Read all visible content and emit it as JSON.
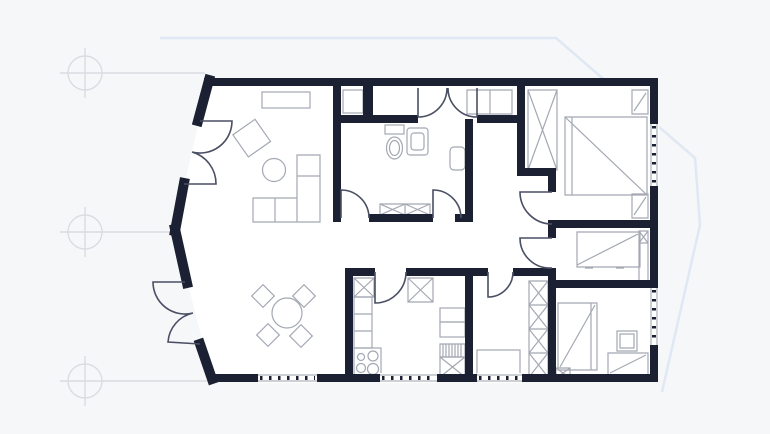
{
  "document": {
    "type": "apartment-floor-plan",
    "canvas": {
      "width": 770,
      "height": 434
    }
  },
  "colors": {
    "page": "#f6f7f9",
    "floor": "#ffffff",
    "wall": "#1c2033",
    "door": "#4a4f63",
    "furniture": "#a3a8b2",
    "window_frame": "#9aa0aa",
    "window_tick": "#1c2033",
    "background_outline": "#e0e8f4",
    "grid": "#d9dce2"
  },
  "layers": [
    {
      "name": "background-grid",
      "stroke": "grid",
      "width": 1.4,
      "items": [
        {
          "name": "grid-line-top",
          "kind": "line",
          "x1": 60,
          "y1": 73,
          "x2": 205,
          "y2": 73
        },
        {
          "name": "grid-line-middle",
          "kind": "line",
          "x1": 60,
          "y1": 232,
          "x2": 172,
          "y2": 232
        },
        {
          "name": "grid-line-bottom",
          "kind": "line",
          "x1": 60,
          "y1": 381,
          "x2": 210,
          "y2": 381
        },
        {
          "name": "grid-cross-top",
          "kind": "line",
          "x1": 85,
          "y1": 48,
          "x2": 85,
          "y2": 98
        },
        {
          "name": "grid-cross-middle",
          "kind": "line",
          "x1": 85,
          "y1": 207,
          "x2": 85,
          "y2": 257
        },
        {
          "name": "grid-cross-bottom",
          "kind": "line",
          "x1": 85,
          "y1": 356,
          "x2": 85,
          "y2": 406
        },
        {
          "name": "grid-marker-top",
          "kind": "circle",
          "cx": 85,
          "cy": 73,
          "r": 17
        },
        {
          "name": "grid-marker-middle",
          "kind": "circle",
          "cx": 85,
          "cy": 232,
          "r": 17
        },
        {
          "name": "grid-marker-bottom",
          "kind": "circle",
          "cx": 85,
          "cy": 381,
          "r": 17
        }
      ]
    },
    {
      "name": "building-outline",
      "stroke": "background_outline",
      "width": 2.5,
      "items": [
        {
          "name": "building-outline-path",
          "kind": "path",
          "d": "M160,38 L556,38 L695,158 L700,225 L662,392"
        }
      ]
    },
    {
      "name": "floor",
      "fill": "floor",
      "items": [
        {
          "name": "floor-area",
          "kind": "polygon",
          "points": "208,82 654,82 654,378 212,378 174,230"
        }
      ]
    },
    {
      "name": "furniture",
      "stroke": "furniture",
      "width": 1.2,
      "items": [
        {
          "name": "sideboard",
          "kind": "rect",
          "x": 262,
          "y": 92,
          "w": 48,
          "h": 16
        },
        {
          "name": "armchair",
          "kind": "rect",
          "x": 238,
          "y": 125,
          "w": 27,
          "h": 27,
          "transform": "rotate(-35 251 138)"
        },
        {
          "name": "coffee-table",
          "kind": "circle",
          "cx": 274,
          "cy": 170,
          "r": 11.5
        },
        {
          "name": "corner-sofa",
          "kind": "path",
          "d": "M253,198 L297,198 L297,155 L320,155 L320,222 L253,222 Z M275,198 L275,222 M297,198 L297,222 M297,176 L320,176"
        },
        {
          "name": "dining-table",
          "kind": "circle",
          "cx": 287,
          "cy": 313,
          "r": 15
        },
        {
          "name": "dining-chair",
          "kind": "rect",
          "x": 255,
          "y": 288,
          "w": 16,
          "h": 16,
          "transform": "rotate(45 263 296)"
        },
        {
          "name": "dining-chair",
          "kind": "rect",
          "x": 296,
          "y": 288,
          "w": 16,
          "h": 16,
          "transform": "rotate(45 304 296)"
        },
        {
          "name": "dining-chair",
          "kind": "rect",
          "x": 260,
          "y": 327,
          "w": 16,
          "h": 16,
          "transform": "rotate(45 268 335)"
        },
        {
          "name": "dining-chair",
          "kind": "rect",
          "x": 293,
          "y": 328,
          "w": 16,
          "h": 16,
          "transform": "rotate(45 301 336)"
        },
        {
          "name": "closet-shelf",
          "kind": "rect",
          "x": 343,
          "y": 90,
          "w": 20,
          "h": 23
        },
        {
          "name": "entry-closet",
          "kind": "path",
          "d": "M467,90 H512 V114 H467 Z M490,90 V114"
        },
        {
          "name": "toilet-tank",
          "kind": "rect",
          "x": 385,
          "y": 125,
          "w": 19,
          "h": 9
        },
        {
          "name": "toilet-bowl",
          "kind": "ellipse",
          "cx": 394.5,
          "cy": 148,
          "rx": 8,
          "ry": 11
        },
        {
          "name": "toilet-bowl-inner",
          "kind": "ellipse",
          "cx": 394.5,
          "cy": 148,
          "rx": 5,
          "ry": 7.5
        },
        {
          "name": "washbasin",
          "kind": "rect",
          "x": 407,
          "y": 128,
          "w": 21,
          "h": 27,
          "rx": 3
        },
        {
          "name": "washbasin-inner",
          "kind": "rect",
          "x": 411,
          "y": 133,
          "w": 13,
          "h": 17,
          "rx": 3
        },
        {
          "name": "wall-basin",
          "kind": "rect",
          "x": 450,
          "y": 147,
          "w": 15,
          "h": 23,
          "rx": 4
        },
        {
          "name": "bath-vanity",
          "kind": "path",
          "d": "M380,204 H430 V215 H380 Z M405,204 V215 M380,204 L405,215 M405,204 L380,215 M405,204 L430,215 M430,204 L405,215"
        },
        {
          "name": "wardrobe",
          "kind": "path",
          "d": "M528,90 H557 V170 H528 Z M528,90 L557,170 M557,90 L528,170"
        },
        {
          "name": "double-bed",
          "kind": "path",
          "d": "M565,117 H647 V195 H565 Z M565,117 L647,195 M572,117 V195"
        },
        {
          "name": "nightstand",
          "kind": "path",
          "d": "M632,90 H648 V114 H632 Z M634,111 L646,93"
        },
        {
          "name": "nightstand",
          "kind": "path",
          "d": "M632,194 H648 V218 H632 Z M634,215 L646,197"
        },
        {
          "name": "single-bed-middle-room",
          "kind": "path",
          "d": "M577,232 H640 V267 H577 Z M577,265 L638,234 M585,268 h8 M616,268 h8"
        },
        {
          "name": "tall-cabinet",
          "kind": "path",
          "d": "M639,231 H648 V281 H639 Z M639,243 H648 M639,231 L648,243 M648,231 L639,243"
        },
        {
          "name": "hall-wardrobe",
          "kind": "path",
          "d": "M529,281 H548 V377 H529 Z M529,305 H548 M529,329 H548 M529,353 H548 M529,281 L548,305 M548,281 L529,305 M529,305 L548,329 M548,305 L529,329 M529,329 L548,353 M548,329 L529,353 M529,353 L548,377 M548,353 L529,377"
        },
        {
          "name": "hall-bench",
          "kind": "rect",
          "x": 477,
          "y": 350,
          "w": 43,
          "h": 26
        },
        {
          "name": "single-bed-lower-room",
          "kind": "path",
          "d": "M558,303 H597 V370 H558 Z M560,367 L595,305 M591,303 V370"
        },
        {
          "name": "bed-foot-box",
          "kind": "path",
          "d": "M556,368 H570 V378 H556 Z M556,368 L570,378 M570,368 L556,378"
        },
        {
          "name": "stool",
          "kind": "path",
          "d": "M617,331 H637 V351 H617 Z M620,334 H634 V348 H620 Z"
        },
        {
          "name": "desk",
          "kind": "path",
          "d": "M608,353 H648 V375 H608 Z M610,373 L646,355"
        },
        {
          "name": "kitchen-upper-cabinet",
          "kind": "path",
          "d": "M354,278 H374 V297 H354 Z M354,278 L374,297 M374,278 L354,297"
        },
        {
          "name": "kitchen-counter",
          "kind": "path",
          "d": "M354,297 H372 V348 H354 Z M354,314 H372 M354,331 H372"
        },
        {
          "name": "stove",
          "kind": "rect",
          "x": 354,
          "y": 348,
          "w": 27,
          "h": 28
        },
        {
          "name": "stove-burner",
          "kind": "circle",
          "cx": 361,
          "cy": 357,
          "r": 3.5
        },
        {
          "name": "stove-burner",
          "kind": "circle",
          "cx": 373,
          "cy": 356,
          "r": 5
        },
        {
          "name": "stove-burner",
          "kind": "circle",
          "cx": 361,
          "cy": 368,
          "r": 4.5
        },
        {
          "name": "stove-burner",
          "kind": "circle",
          "cx": 373,
          "cy": 369,
          "r": 5.5
        },
        {
          "name": "kitchen-cabinet",
          "kind": "path",
          "d": "M408,278 H433 V302 H408 Z M408,278 L433,302 M433,278 L408,302"
        },
        {
          "name": "appliance",
          "kind": "rect",
          "x": 440,
          "y": 308,
          "w": 25,
          "h": 14
        },
        {
          "name": "appliance",
          "kind": "rect",
          "x": 440,
          "y": 322,
          "w": 25,
          "h": 15
        },
        {
          "name": "sink-unit",
          "kind": "path",
          "d": "M440,344 H465 V357 H440 Z M443,344 V357 M446,344 V357 M449,344 V357 M452,344 V357 M455,344 V357 M458,344 V357 M461,344 V357"
        },
        {
          "name": "kitchen-base-cabinet",
          "kind": "path",
          "d": "M440,357 H465 V377 H440 Z M440,357 L465,377 M465,357 L440,377"
        }
      ]
    },
    {
      "name": "walls",
      "fill": "wall",
      "items": [
        {
          "name": "wall-top",
          "kind": "rect",
          "x": 204,
          "y": 78,
          "w": 454,
          "h": 8
        },
        {
          "name": "wall-right",
          "kind": "rect",
          "x": 650,
          "y": 78,
          "w": 8,
          "h": 304
        },
        {
          "name": "wall-bottom",
          "kind": "rect",
          "x": 208,
          "y": 374,
          "w": 450,
          "h": 8
        },
        {
          "name": "wall-living-bath",
          "kind": "rect",
          "x": 333,
          "y": 78,
          "w": 8,
          "h": 144
        },
        {
          "name": "wall-bath-bottom",
          "kind": "rect",
          "x": 333,
          "y": 214,
          "w": 8,
          "h": 8
        },
        {
          "name": "wall-bath-bottom",
          "kind": "rect",
          "x": 369,
          "y": 214,
          "w": 64,
          "h": 8
        },
        {
          "name": "wall-bath-bottom",
          "kind": "rect",
          "x": 455,
          "y": 214,
          "w": 18,
          "h": 8
        },
        {
          "name": "wall-bath-right",
          "kind": "rect",
          "x": 465,
          "y": 119,
          "w": 8,
          "h": 103
        },
        {
          "name": "wall-niche-bottom",
          "kind": "rect",
          "x": 337,
          "y": 115,
          "w": 81,
          "h": 8
        },
        {
          "name": "wall-niche-bottom",
          "kind": "rect",
          "x": 477,
          "y": 115,
          "w": 41,
          "h": 8
        },
        {
          "name": "wall-closet",
          "kind": "rect",
          "x": 363,
          "y": 86,
          "w": 10,
          "h": 33
        },
        {
          "name": "wall-bedroom-left",
          "kind": "rect",
          "x": 517,
          "y": 78,
          "w": 8,
          "h": 96
        },
        {
          "name": "wall-bedroom-stub",
          "kind": "rect",
          "x": 517,
          "y": 168,
          "w": 36,
          "h": 8
        },
        {
          "name": "wall-corridor",
          "kind": "rect",
          "x": 548,
          "y": 168,
          "w": 8,
          "h": 24
        },
        {
          "name": "wall-corridor",
          "kind": "rect",
          "x": 548,
          "y": 222,
          "w": 8,
          "h": 16
        },
        {
          "name": "wall-corridor",
          "kind": "rect",
          "x": 548,
          "y": 268,
          "w": 8,
          "h": 112
        },
        {
          "name": "wall-bedroom-divider",
          "kind": "rect",
          "x": 548,
          "y": 220,
          "w": 110,
          "h": 8
        },
        {
          "name": "wall-room-divider",
          "kind": "rect",
          "x": 548,
          "y": 280,
          "w": 110,
          "h": 8
        },
        {
          "name": "wall-kitchen-top",
          "kind": "rect",
          "x": 345,
          "y": 268,
          "w": 30,
          "h": 8
        },
        {
          "name": "wall-hall-top",
          "kind": "rect",
          "x": 406,
          "y": 268,
          "w": 82,
          "h": 8
        },
        {
          "name": "wall-hall-top",
          "kind": "rect",
          "x": 513,
          "y": 268,
          "w": 39,
          "h": 8
        },
        {
          "name": "wall-kitchen-left",
          "kind": "rect",
          "x": 345,
          "y": 268,
          "w": 8,
          "h": 112
        },
        {
          "name": "wall-kitchen-right",
          "kind": "rect",
          "x": 465,
          "y": 268,
          "w": 8,
          "h": 112
        }
      ]
    },
    {
      "name": "walls-slanted",
      "stroke": "wall",
      "width": 10,
      "items": [
        {
          "name": "wall-slant-upper",
          "kind": "line",
          "x1": 209,
          "y1": 80,
          "x2": 198,
          "y2": 121,
          "cap": "square"
        },
        {
          "name": "wall-slant-upper",
          "kind": "line",
          "x1": 184,
          "y1": 183,
          "x2": 175,
          "y2": 231,
          "cap": "square"
        },
        {
          "name": "wall-slant-lower",
          "kind": "line",
          "x1": 175,
          "y1": 229,
          "x2": 187,
          "y2": 283,
          "cap": "square"
        },
        {
          "name": "wall-slant-lower",
          "kind": "line",
          "x1": 200,
          "y1": 344,
          "x2": 212,
          "y2": 379,
          "cap": "square"
        }
      ]
    },
    {
      "name": "windows",
      "items": [
        {
          "name": "window-bedroom",
          "kind": "window",
          "x": 649,
          "y": 124,
          "w": 10,
          "h": 62,
          "o": "v"
        },
        {
          "name": "window-lower-bedroom",
          "kind": "window",
          "x": 649,
          "y": 288,
          "w": 10,
          "h": 57,
          "o": "v"
        },
        {
          "name": "window-living",
          "kind": "window",
          "x": 258,
          "y": 373,
          "w": 59,
          "h": 10,
          "o": "h"
        },
        {
          "name": "window-kitchen",
          "kind": "window",
          "x": 380,
          "y": 373,
          "w": 57,
          "h": 10,
          "o": "h"
        },
        {
          "name": "window-hall",
          "kind": "window",
          "x": 477,
          "y": 373,
          "w": 45,
          "h": 10,
          "o": "h"
        }
      ]
    },
    {
      "name": "doors",
      "stroke": "door",
      "width": 1.6,
      "items": [
        {
          "name": "french-door-upper",
          "kind": "path",
          "d": "M200,121 L232,121 A32,32 0 0 1 192,152 M184,184 L216,184 A33,33 0 0 0 192,152"
        },
        {
          "name": "french-door-lower",
          "kind": "path",
          "d": "M185,282 L153,282 A32,32 0 0 0 193,313 M200,344 L168,342 A32,32 0 0 1 193,313"
        },
        {
          "name": "entrance-double-door",
          "kind": "path",
          "d": "M418,117 L418,88 M418,117 A29,29 0 0 0 447,88 M477,117 L477,88 M477,117 A29,29 0 0 1 448,88"
        },
        {
          "name": "bath-door-left",
          "kind": "path",
          "d": "M341,218 L341,190 A28,28 0 0 1 369,218"
        },
        {
          "name": "bath-door-right",
          "kind": "path",
          "d": "M433,218 L433,190 A28,28 0 0 1 461,218"
        },
        {
          "name": "bedroom-door",
          "kind": "path",
          "d": "M552,192 L520,192 A32,32 0 0 0 552,224"
        },
        {
          "name": "middle-room-door",
          "kind": "path",
          "d": "M552,238 L520,238 A30,30 0 0 0 552,268"
        },
        {
          "name": "kitchen-door",
          "kind": "path",
          "d": "M375,272 L375,303 A31,31 0 0 0 406,272"
        },
        {
          "name": "hall-door",
          "kind": "path",
          "d": "M488,272 L488,297 A25,25 0 0 0 513,272"
        }
      ]
    }
  ]
}
